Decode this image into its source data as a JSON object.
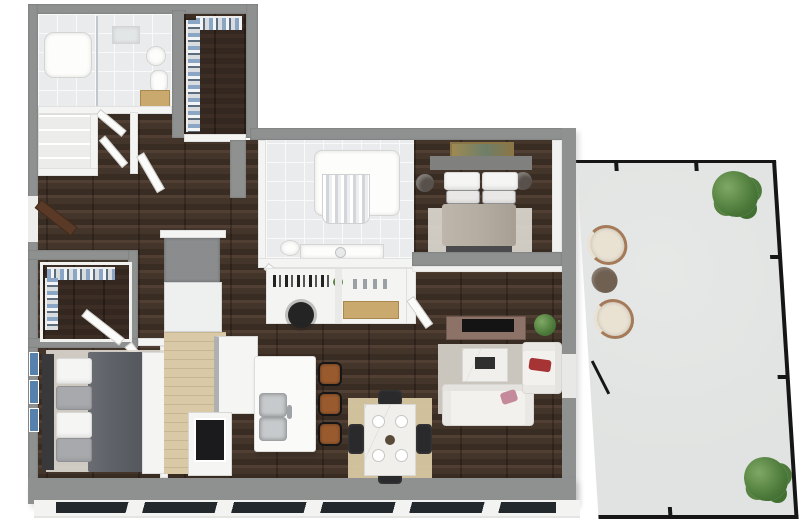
{
  "meta": {
    "description": "Photoreal 3D top-down floor plan rendering of a two-bedroom two-bath apartment with study nook, island kitchen, walk-in closets and a large wrap-around patio",
    "render_style": "isometric dollhouse 3D render",
    "background": "#ffffff",
    "visible_text": ""
  },
  "palette": {
    "exterior_wall": "#8f9090",
    "interior_wall": "#f4f4f3",
    "tile_floor": "#eaebec",
    "tile_grout": "#f9f9fa",
    "kitchen_floor": "#d9c9a6",
    "patio_floor": "#e1e3e2",
    "railing": "#161616",
    "sofa_white": "#f2f1ee",
    "accent_red_pillow": "#a63434",
    "accent_pink_pillow": "#c4899a",
    "tv_console": "#8d7268",
    "tv_black": "#141414",
    "rug_living": "#cbc6bd",
    "rug_dining": "#d8c8a2",
    "rug_bedroom": "#dcd8cf",
    "marble": "#f1efeb",
    "chair_black": "#2a2a2c",
    "stool_brown": "#995a2e",
    "bed1_duvet": "#b5ada2",
    "bed1_headboard": "#80807f",
    "bed2_duvet": "#5f6268",
    "bed2_headboard": "#39393b",
    "pillow_white": "#f5f5f4",
    "nightstand": "#57504b",
    "art_blue": "#5581ac",
    "door_wood": "#5a3a26",
    "cream_chair": "#e9e1d2",
    "chair_rim": "#a47a58",
    "patio_table": "#6f6052",
    "steel": "#c7cacc",
    "appliance_gray": "#8a8c8e",
    "oven_black": "#1b1b1d",
    "vanity_wood": "#c9a96e",
    "wood_floor_base": "#44352b",
    "closet_floor": "#33271f",
    "window_glass": "#23282d"
  },
  "rooms": [
    {
      "id": "primary-bathroom",
      "name": "Primary Bathroom",
      "floor": "white tile",
      "furniture": [
        "bathtub",
        "glass shower",
        "round sink",
        "toilet",
        "wood vanity stool",
        "towel rack"
      ]
    },
    {
      "id": "walk-in-closet-1",
      "name": "Walk-in Closet 1",
      "floor": "dark wood",
      "furniture": [
        "hanging clothes on two rails"
      ]
    },
    {
      "id": "linen-closet",
      "name": "Linen Closet",
      "floor": "white",
      "furniture": [
        "built-in shelves"
      ]
    },
    {
      "id": "entry-hall",
      "name": "Entry Hall",
      "floor": "dark wood",
      "furniture": [
        "wood entry door",
        "open interior doors"
      ]
    },
    {
      "id": "walk-in-closet-2",
      "name": "Walk-in Closet 2",
      "floor": "dark wood",
      "furniture": [
        "hanging clothes on two rails",
        "open door"
      ]
    },
    {
      "id": "bedroom-2",
      "name": "Bedroom 2",
      "floor": "dark wood",
      "furniture": [
        "queen bed with dark gray duvet",
        "dark headboard",
        "gray and white pillows",
        "area rug",
        "three blue wall-art pieces"
      ]
    },
    {
      "id": "kitchen",
      "name": "Kitchen",
      "floor": "light oak",
      "furniture": [
        "tall refrigerator cabinet",
        "L-shaped counter",
        "black range oven"
      ]
    },
    {
      "id": "dining-area",
      "name": "Dining Area",
      "floor": "dark wood",
      "furniture": [
        "marble dining table",
        "four dark chairs",
        "four place settings",
        "tan area rug"
      ]
    },
    {
      "id": "living-room",
      "name": "Living Room",
      "floor": "dark wood",
      "furniture": [
        "media console",
        "flat TV",
        "potted plant",
        "marble coffee table",
        "white sofa with pink pillow",
        "white accent chair with red pillow",
        "area rug"
      ]
    },
    {
      "id": "bathroom-2",
      "name": "Bathroom 2",
      "floor": "white tile",
      "furniture": [
        "tub shower with curtain",
        "vanity with sink",
        "toilet"
      ]
    },
    {
      "id": "study-nook",
      "name": "Study Nook",
      "floor": "white",
      "furniture": [
        "built-in desk with shelves",
        "black office chair",
        "console cabinet with wood drawers"
      ]
    },
    {
      "id": "bedroom-1",
      "name": "Bedroom 1",
      "floor": "dark wood",
      "furniture": [
        "queen bed with taupe duvet",
        "gray headboard",
        "four pillows",
        "two round nightstands with lamps",
        "gold landscape wall art",
        "area rug",
        "foot bench"
      ]
    },
    {
      "id": "patio",
      "name": "Patio",
      "floor": "light concrete",
      "furniture": [
        "two cream barrel chairs",
        "round brown side table",
        "two potted plants",
        "black metal railing"
      ]
    }
  ],
  "other_features": {
    "kitchen_island": [
      "white waterfall island",
      "double stainless sink",
      "three leather bar stools"
    ],
    "windows": "floor-to-ceiling glass along bottom exterior wall",
    "patio_access": "glass door from living room"
  }
}
